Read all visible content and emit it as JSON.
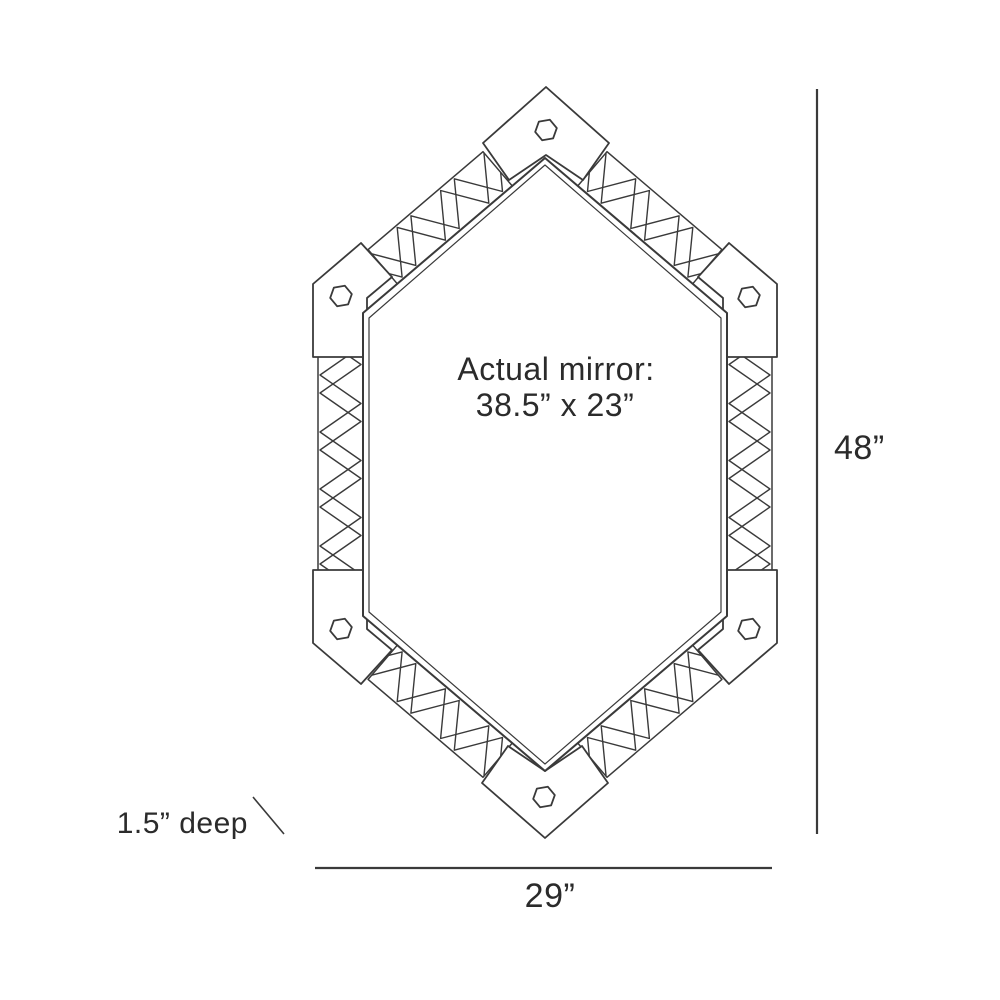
{
  "diagram": {
    "mirror_label": {
      "line1": "Actual mirror:",
      "line2": "38.5” x 23”"
    },
    "dimensions": {
      "height": "48”",
      "width": "29”",
      "depth": "1.5” deep"
    }
  },
  "colors": {
    "line": "#3a3a3a",
    "text": "#2b2b2b",
    "background": "#ffffff"
  }
}
